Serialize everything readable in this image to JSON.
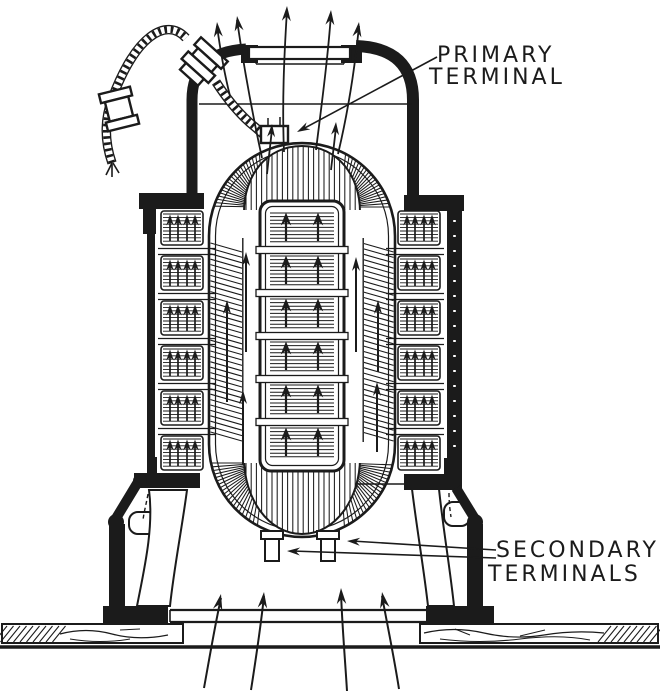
{
  "meta": {
    "title": "Transformer cross-section engraving",
    "style": "black-and-white line engraving"
  },
  "palette": {
    "background": "#ffffff",
    "ink": "#1b1b1b"
  },
  "labels": {
    "primary_terminal": {
      "line1": "PRIMARY",
      "line2": "TERMINAL"
    },
    "secondary_terminals": {
      "line1": "SECONDARY",
      "line2": "TERMINALS"
    }
  },
  "figure": {
    "core_block_rows_center": 6,
    "side_limb_block_rows": 6,
    "secondary_terminal_lugs": 2,
    "air_outlet_arrows": 5,
    "air_inlet_arrows": 4
  }
}
